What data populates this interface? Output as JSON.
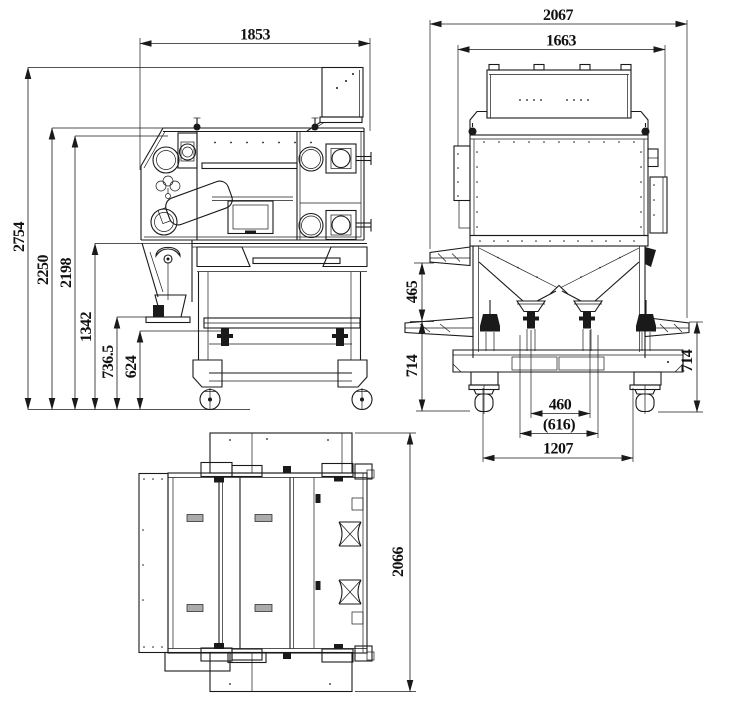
{
  "dims": {
    "d1853": "1853",
    "d2067": "2067",
    "d1663": "1663",
    "d2754": "2754",
    "d2250": "2250",
    "d2198": "2198",
    "d1342": "1342",
    "d736_5": "736.5",
    "d624": "624",
    "d465": "465",
    "d714_left": "714",
    "d714_right": "714",
    "d460": "460",
    "d616": "(616)",
    "d1207": "1207",
    "d2066": "2066"
  },
  "colors": {
    "line": "#1a1a1a",
    "background": "#ffffff"
  }
}
